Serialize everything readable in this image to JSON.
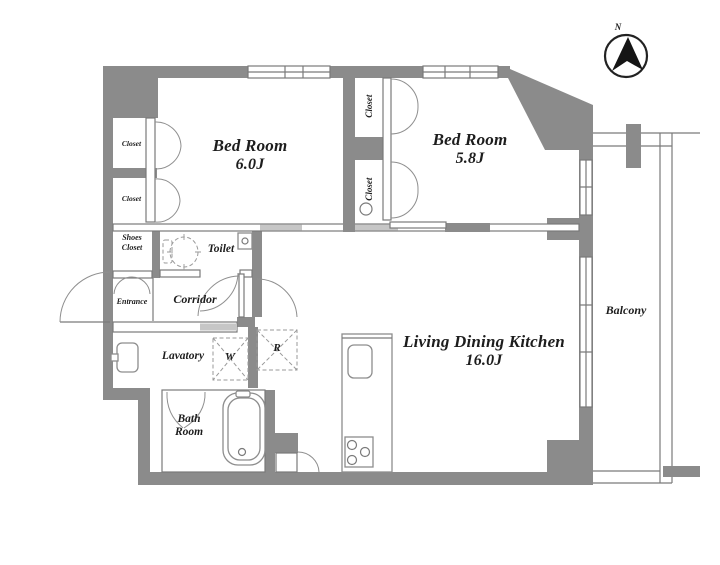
{
  "colors": {
    "wall": "#8b8b8b",
    "line": "#7a7a7a",
    "text": "#1d1d1d",
    "bg": "#ffffff",
    "lite": "#c6c6c6"
  },
  "compass": {
    "label": "N"
  },
  "rooms": {
    "bedroom_1": {
      "name": "Bed Room",
      "size": "6.0J"
    },
    "bedroom_2": {
      "name": "Bed Room",
      "size": "5.8J"
    },
    "living": {
      "name": "Living Dining Kitchen",
      "size": "16.0J"
    },
    "balcony": {
      "name": "Balcony"
    },
    "toilet": {
      "name": "Toilet"
    },
    "corridor": {
      "name": "Corridor"
    },
    "entrance": {
      "name": "Entrance"
    },
    "shoes_closet": {
      "line1": "Shoes",
      "line2": "Closet"
    },
    "lavatory": {
      "name": "Lavatory"
    },
    "bath": {
      "line1": "Bath",
      "line2": "Room"
    },
    "closet_label": "Closet"
  },
  "fixtures": {
    "washing_machine": "W",
    "refrigerator": "R"
  }
}
